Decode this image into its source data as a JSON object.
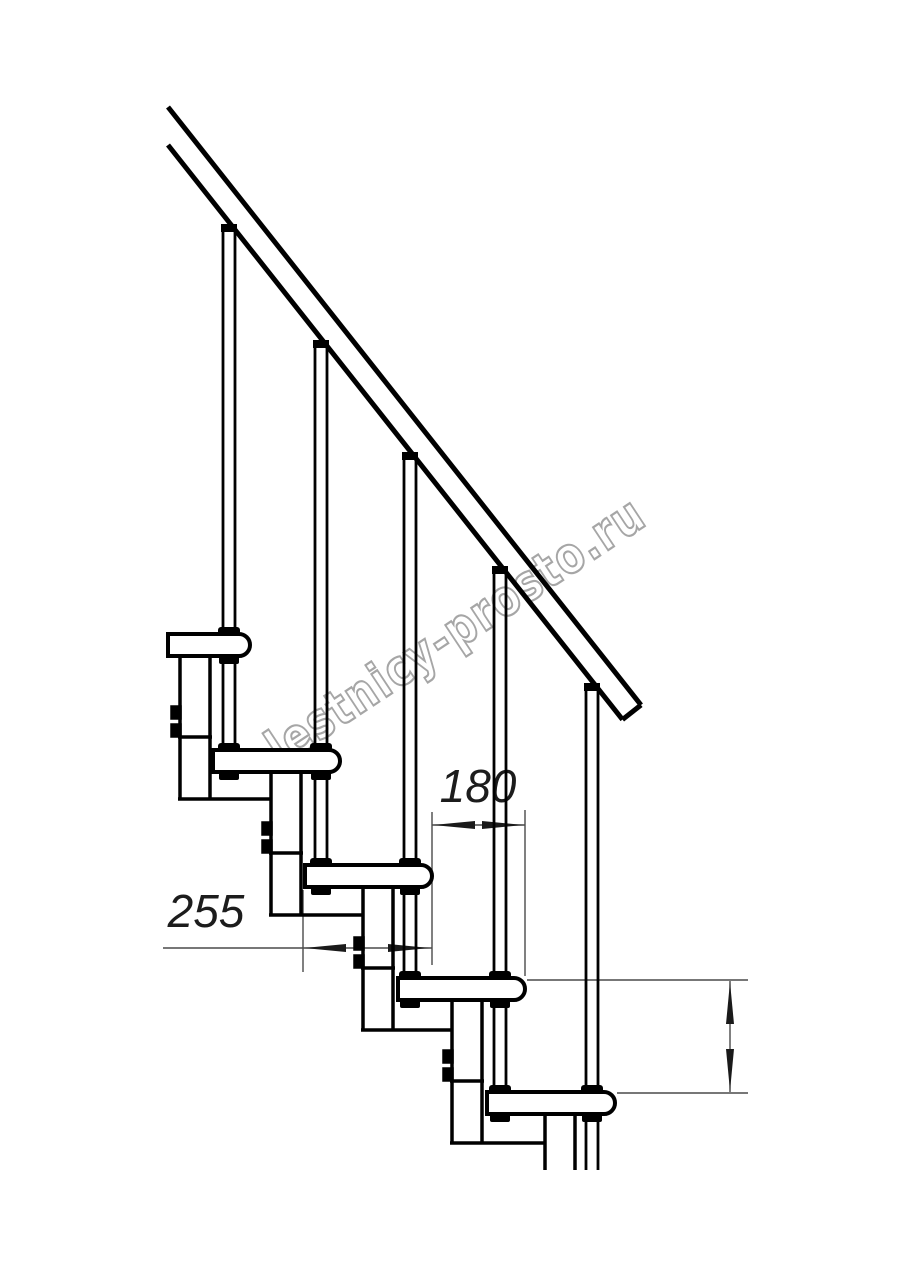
{
  "drawing": {
    "watermark": "lestnicy-prosto.ru",
    "dimensions": {
      "tread_depth": "255",
      "step_run": "180",
      "step_rise": "225"
    }
  }
}
